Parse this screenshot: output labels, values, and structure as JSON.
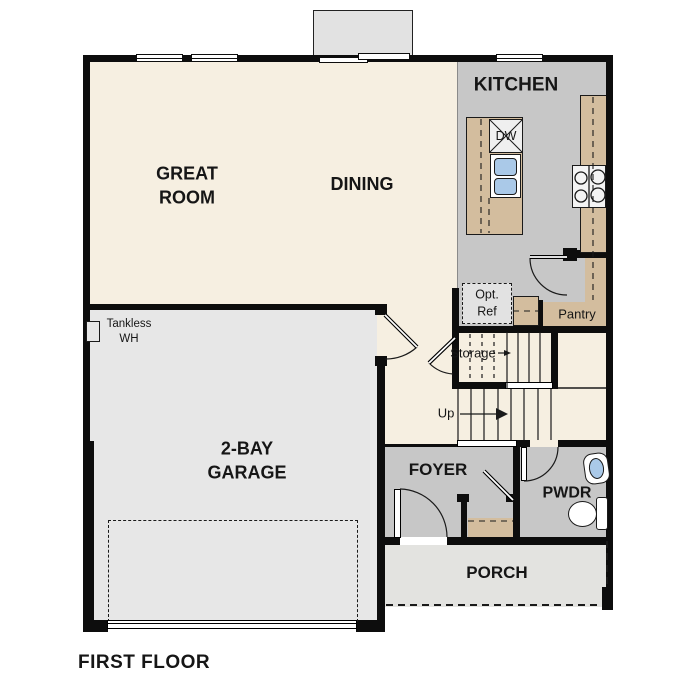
{
  "title": "First floor plan",
  "colors": {
    "wall": "#0d0d0d",
    "floor-cream": "#f6efe1",
    "room-gray": "#c7c7c7",
    "garage-gray": "#e7e7e7",
    "porch-gray": "#e3e3e0",
    "counter-tan": "#d3bd9e",
    "sink-blue": "#aac9e8",
    "bump-gray": "#e2e2e2",
    "optref-gray": "#e2e2e2"
  },
  "rooms": {
    "great_room": {
      "line1": "GREAT",
      "line2": "ROOM"
    },
    "dining": {
      "label": "DINING"
    },
    "kitchen": {
      "label": "KITCHEN"
    },
    "garage": {
      "line1": "2-BAY",
      "line2": "GARAGE"
    },
    "foyer": {
      "label": "FOYER"
    },
    "powder": {
      "label": "PWDR"
    },
    "porch": {
      "label": "PORCH"
    },
    "pantry": {
      "label": "Pantry"
    }
  },
  "annotations": {
    "storage": "Storage",
    "up": "Up",
    "opt_ref": {
      "line1": "Opt.",
      "line2": "Ref"
    },
    "tankless": {
      "line1": "Tankless",
      "line2": "WH"
    },
    "dishwasher": "DW"
  },
  "footer": {
    "plan_label": "FIRST FLOOR"
  }
}
